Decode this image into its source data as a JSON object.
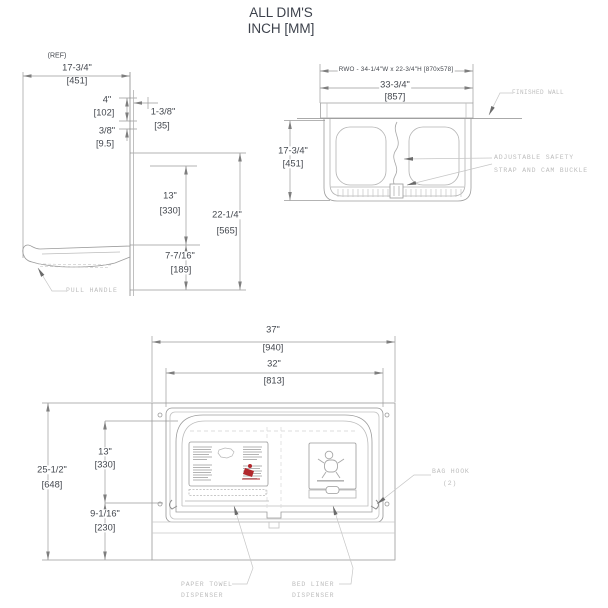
{
  "title": {
    "line1": "ALL DIM'S",
    "line2": "INCH [MM]"
  },
  "side_view": {
    "ref_note": "(REF)",
    "depth_in": "17-3/4\"",
    "depth_mm": "[451]",
    "top_offset_in": "4\"",
    "top_offset_mm": "[102]",
    "lip_in": "1-3/8\"",
    "lip_mm": "[35]",
    "gap_in": "3/8\"",
    "gap_mm": "[9.5]",
    "bed_height_in": "13\"",
    "bed_height_mm": "[330]",
    "overall_height_in": "22-1/4\"",
    "overall_height_mm": "[565]",
    "lower_height_in": "7-7/16\"",
    "lower_height_mm": "[189]",
    "pull_handle_label": "PULL HANDLE"
  },
  "plan_view": {
    "rough_wall_opening": "RWO - 34-1/4\"W x 22-3/4\"H [870x578]",
    "width_in": "33-3/4\"",
    "width_mm": "[857]",
    "depth_in": "17-3/4\"",
    "depth_mm": "[451]",
    "finished_wall_label": "FINISHED WALL",
    "strap_label_line1": "ADJUSTABLE SAFETY",
    "strap_label_line2": "STRAP AND CAM BUCKLE"
  },
  "front_view": {
    "overall_width_in": "37\"",
    "overall_width_mm": "[940]",
    "flange_width_in": "32\"",
    "flange_width_mm": "[813]",
    "overall_height_in": "25-1/2\"",
    "overall_height_mm": "[648]",
    "upper_height_in": "13\"",
    "upper_height_mm": "[330]",
    "lower_height_in": "9-1/16\"",
    "lower_height_mm": "[230]",
    "bag_hook_label_line1": "BAG HOOK",
    "bag_hook_label_line2": "(2)",
    "paper_towel_label_line1": "PAPER TOWEL",
    "paper_towel_label_line2": "DISPENSER",
    "bed_liner_label_line1": "BED LINER",
    "bed_liner_label_line2": "DISPENSER"
  },
  "colors": {
    "dim_text": "#43474e",
    "leader_text": "#bdbdbd",
    "line": "#9a9a9a",
    "red_accent": "#b1272c"
  }
}
